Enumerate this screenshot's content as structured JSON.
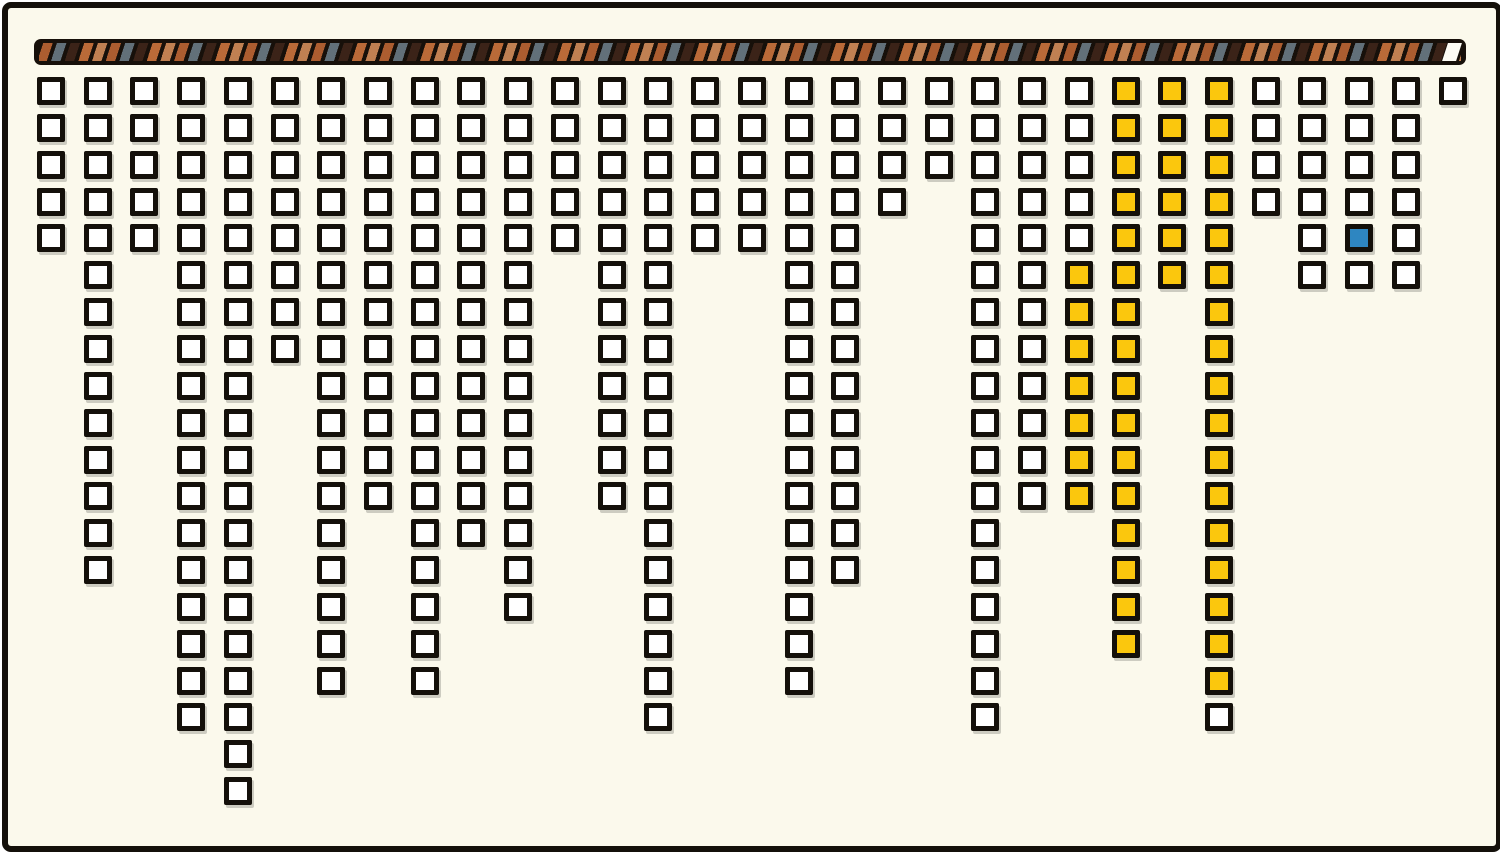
{
  "canvas": {
    "background": "#FBF9EC",
    "frame_color": "#14100A",
    "outer_background": "#FFFFFF"
  },
  "rod": {
    "base_color": "#17100A",
    "stripe_colors": [
      "#AC5D30",
      "#627079",
      "#3B2318",
      "#BA6A38",
      "#C08052"
    ],
    "end_cap_color": "#FDFCF5"
  },
  "squares": {
    "white_fill": "#FFFFFF",
    "yellow_fill": "#FBC70D",
    "blue_fill": "#2E86C1",
    "border_color": "#14100A",
    "shadow_color": "rgba(0,0,0,0.18)"
  },
  "chart_data": {
    "type": "waffle",
    "orientation": "columns-hanging-from-top-rod",
    "max_rows": 20,
    "num_columns": 31,
    "total_squares": 332,
    "columns": [
      {
        "count": 5
      },
      {
        "count": 14
      },
      {
        "count": 5
      },
      {
        "count": 18
      },
      {
        "count": 20
      },
      {
        "count": 8
      },
      {
        "count": 17
      },
      {
        "count": 12
      },
      {
        "count": 17
      },
      {
        "count": 13
      },
      {
        "count": 15
      },
      {
        "count": 5
      },
      {
        "count": 12
      },
      {
        "count": 18
      },
      {
        "count": 5
      },
      {
        "count": 5
      },
      {
        "count": 17
      },
      {
        "count": 14
      },
      {
        "count": 4
      },
      {
        "count": 3
      },
      {
        "count": 18
      },
      {
        "count": 12
      },
      {
        "count": 12,
        "yellow_from": 6,
        "yellow_to": 12
      },
      {
        "count": 16,
        "yellow_from": 1,
        "yellow_to": 16
      },
      {
        "count": 6,
        "yellow_from": 1,
        "yellow_to": 6
      },
      {
        "count": 18,
        "yellow_from": 1,
        "yellow_to": 17
      },
      {
        "count": 4
      },
      {
        "count": 6
      },
      {
        "count": 6,
        "blue_row": 5
      },
      {
        "count": 6
      },
      {
        "count": 1
      }
    ]
  }
}
